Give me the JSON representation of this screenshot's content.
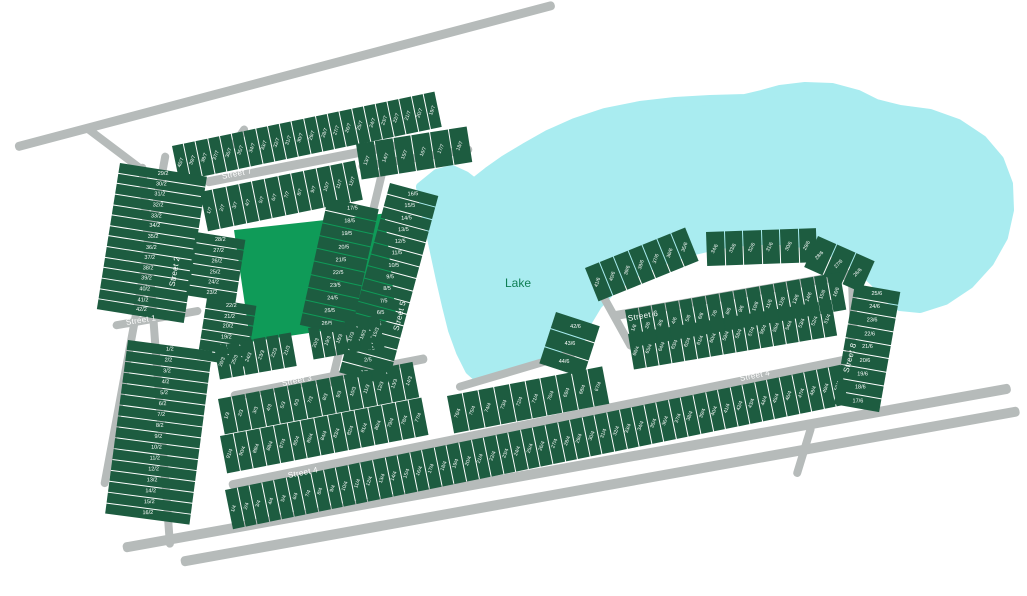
{
  "map": {
    "lake": {
      "label": "Lake"
    },
    "street_names": {
      "s1": "Street 1",
      "s2": "Street 2",
      "s3": "Street 3",
      "s4": "Street 4",
      "s5": "Street 5",
      "s6": "Street 6",
      "s7": "Street 7",
      "s8": "Street 8"
    },
    "blocks": {
      "s7_north": [
        "40/7",
        "39/7",
        "38/7",
        "37/7",
        "36/7",
        "35/7",
        "34/7",
        "33/7",
        "32/7",
        "31/7",
        "30/7",
        "29/7",
        "28/7",
        "27/7",
        "26/7",
        "25/7",
        "24/7",
        "23/7",
        "22/7",
        "21/7",
        "20/7",
        "19/7"
      ],
      "s7_lakeside": [
        "13/7",
        "14/7",
        "15/7",
        "16/7",
        "17/7",
        "18/7"
      ],
      "s7_south": [
        "1/7",
        "2/7",
        "3/7",
        "4/7",
        "5/7",
        "6/7",
        "7/7",
        "8/7",
        "9/7",
        "10/7",
        "11/7",
        "12/7"
      ],
      "s2_col_upper": [
        "29/2",
        "30/2",
        "31/2",
        "32/2",
        "33/2",
        "34/2",
        "35/2",
        "36/2",
        "37/2",
        "38/2",
        "39/2",
        "40/2",
        "41/2",
        "42/2"
      ],
      "s2_col_lower": [
        "1/2",
        "2/2",
        "3/2",
        "4/2",
        "5/2",
        "6/2",
        "7/2",
        "8/2",
        "9/2",
        "10/2",
        "11/2",
        "12/2",
        "13/2",
        "14/2",
        "15/2",
        "16/2"
      ],
      "s2_east_a": [
        "28/2",
        "27/2",
        "26/2",
        "25/2",
        "24/2",
        "23/2"
      ],
      "s2_east_b": [
        "22/2",
        "21/2",
        "20/2",
        "19/2",
        "18/2",
        "17/2"
      ],
      "s5_west": [
        "17/5",
        "18/5",
        "19/5",
        "20/5",
        "21/5",
        "22/5",
        "23/5",
        "24/5",
        "25/5",
        "26/5"
      ],
      "s5_east": [
        "16/5",
        "15/5",
        "14/5",
        "13/5",
        "12/5",
        "11/5",
        "10/5",
        "9/5",
        "8/5",
        "7/5",
        "6/5",
        "5/5",
        "4/5",
        "3/5",
        "2/5",
        "1/5"
      ],
      "s3_above_w": [
        "26/3",
        "25/3",
        "24/3",
        "23/3",
        "22/3",
        "21/3"
      ],
      "s3_above_e": [
        "20/3",
        "19/3",
        "18/3",
        "17/3",
        "16/3",
        "15/3"
      ],
      "s3_below": [
        "1/3",
        "2/3",
        "3/3",
        "4/3",
        "5/3",
        "6/3",
        "7/3",
        "8/3",
        "9/3",
        "10/3",
        "11/3",
        "12/3",
        "13/3",
        "14/3"
      ],
      "s4_above_w": [
        "91/4",
        "90/4",
        "89/4",
        "88/4",
        "87/4",
        "86/4",
        "85/4",
        "84/4",
        "83/4",
        "82/4",
        "81/4",
        "80/4",
        "79/4",
        "78/4",
        "77/4"
      ],
      "s4_above_m": [
        "76/4",
        "75/4",
        "74/4",
        "73/4",
        "72/4",
        "71/4",
        "70/4",
        "69/4",
        "68/4",
        "67/4"
      ],
      "s4_above_e": [
        "66/4",
        "65/4",
        "64/4",
        "63/4",
        "62/4",
        "61/4",
        "60/4",
        "59/4",
        "58/4",
        "57/4",
        "56/4",
        "55/4",
        "54/4",
        "53/4",
        "52/4",
        "51/4"
      ],
      "s4_below": [
        "1/4",
        "2/4",
        "3/4",
        "4/4",
        "5/4",
        "6/4",
        "7/4",
        "8/4",
        "9/4",
        "10/4",
        "11/4",
        "12/4",
        "13/4",
        "14/4",
        "15/4",
        "16/4",
        "17/4",
        "18/4",
        "19/4",
        "20/4",
        "21/4",
        "22/4",
        "23/4",
        "24/4",
        "25/4",
        "26/4",
        "27/4",
        "28/4",
        "29/4",
        "30/4",
        "31/4",
        "32/4",
        "33/4",
        "34/4",
        "35/4",
        "36/4",
        "37/4",
        "38/4",
        "39/4",
        "40/4",
        "41/4",
        "42/4",
        "43/4",
        "44/4",
        "45/4",
        "46/4",
        "47/4",
        "48/4",
        "49/4",
        "50/4"
      ],
      "s6_outer_col_left": [
        "42/6",
        "43/6",
        "44/6"
      ],
      "s6_outer_arc_nw": [
        "41/6",
        "40/6",
        "39/6",
        "38/6",
        "37/6",
        "36/6",
        "35/6"
      ],
      "s6_outer_arc_n": [
        "34/6",
        "33/6",
        "32/6",
        "31/6",
        "30/6",
        "29/6"
      ],
      "s6_outer_arc_ne": [
        "28/6",
        "27/6",
        "26/6"
      ],
      "s6_outer_col_right": [
        "25/6",
        "24/6",
        "23/6",
        "22/6",
        "21/6",
        "20/6",
        "19/6",
        "18/6",
        "17/6"
      ],
      "s6_inner": [
        "1/6",
        "2/6",
        "3/6",
        "4/6",
        "5/6",
        "6/6",
        "7/6",
        "8/6",
        "9/6",
        "10/6",
        "11/6",
        "12/6",
        "13/6",
        "14/6",
        "15/6",
        "16/6"
      ]
    }
  },
  "colors": {
    "lot": "#1d5c40",
    "park": "#0f9b58",
    "lake": "#a9ecf0",
    "road": "#b6bbba",
    "lot_text": "#ffffff",
    "lake_text": "#0e7e53"
  }
}
